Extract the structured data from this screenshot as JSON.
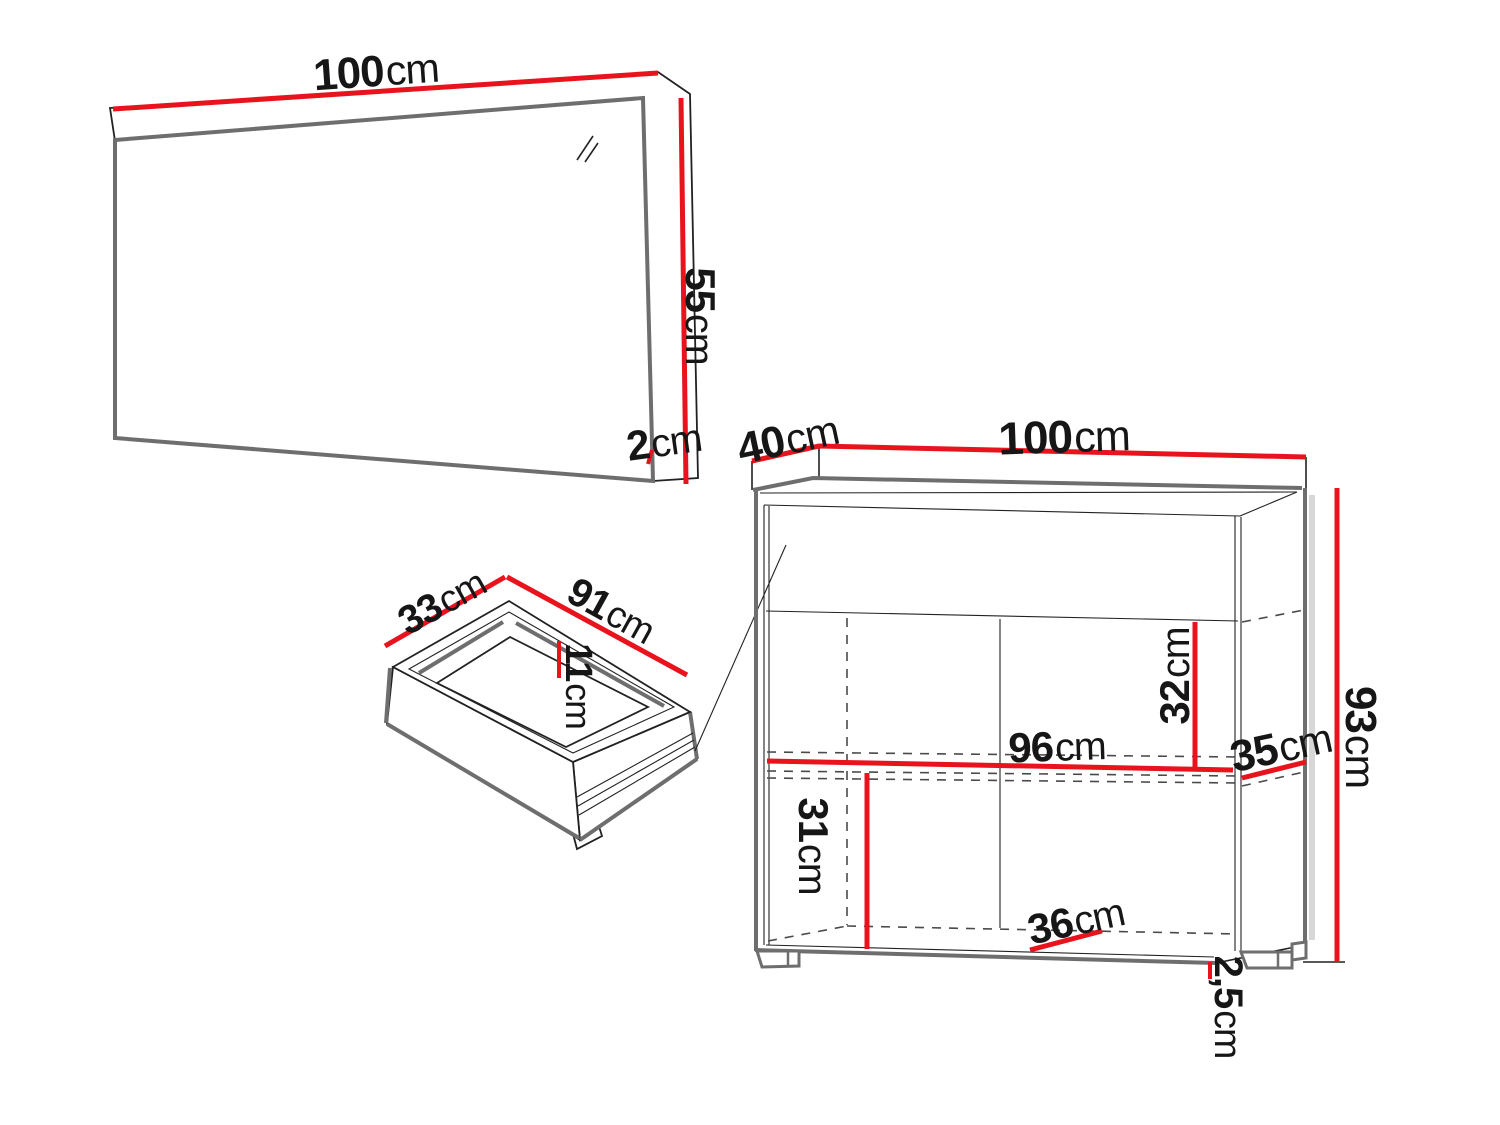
{
  "figure": {
    "type": "furniture-dimension-diagram",
    "pieces": [
      "mirror",
      "drawer",
      "cabinet"
    ]
  },
  "colors": {
    "dimension_red": "#e8131c",
    "outline_gray": "#6e6e6e",
    "line_dark": "#222222",
    "background": "#ffffff"
  },
  "dimensions": {
    "mirror_width": {
      "value": "100",
      "unit": "cm"
    },
    "mirror_height": {
      "value": "55",
      "unit": "cm"
    },
    "mirror_depth": {
      "value": "2",
      "unit": "cm"
    },
    "drawer_depth": {
      "value": "33",
      "unit": "cm"
    },
    "drawer_width": {
      "value": "91",
      "unit": "cm"
    },
    "drawer_height": {
      "value": "11",
      "unit": "cm"
    },
    "cabinet_depth": {
      "value": "40",
      "unit": "cm"
    },
    "cabinet_width": {
      "value": "100",
      "unit": "cm"
    },
    "cabinet_height": {
      "value": "93",
      "unit": "cm"
    },
    "cabinet_upper_inner_height": {
      "value": "32",
      "unit": "cm"
    },
    "cabinet_inner_width": {
      "value": "96",
      "unit": "cm"
    },
    "cabinet_shelf_depth": {
      "value": "35",
      "unit": "cm"
    },
    "cabinet_lower_inner_height": {
      "value": "31",
      "unit": "cm"
    },
    "cabinet_bottom_depth": {
      "value": "36",
      "unit": "cm"
    },
    "cabinet_plinth_height": {
      "value": "2,5",
      "unit": "cm"
    }
  }
}
